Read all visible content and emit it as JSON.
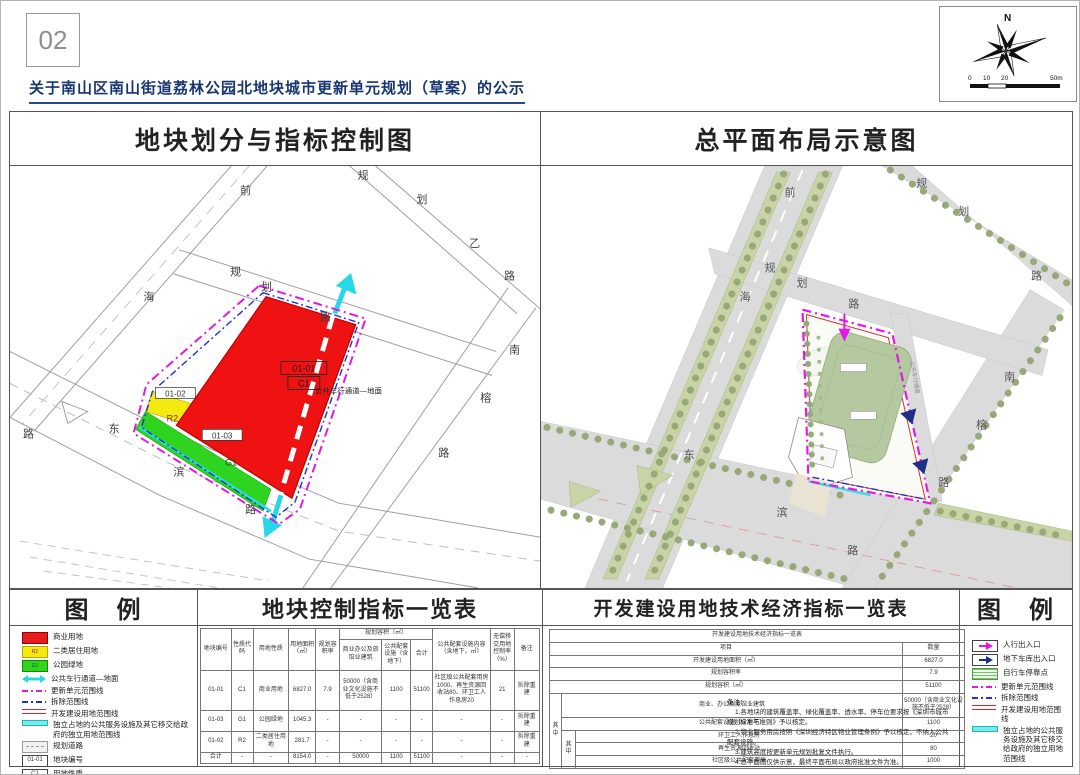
{
  "page": {
    "number": "02",
    "title": "关于南山区南山街道荔林公园北地块城市更新单元规划（草案）的公示"
  },
  "compass": {
    "north_label": "N",
    "scale_labels": [
      "0",
      "10",
      "20",
      "50m"
    ]
  },
  "panels": {
    "left_title": "地块划分与指标控制图",
    "right_title": "总平面布局示意图"
  },
  "left_map": {
    "roads": {
      "qianhai": [
        "前",
        "海",
        "路"
      ],
      "guihua": [
        "规",
        "划",
        "路"
      ],
      "guihuayi": [
        "规",
        "划",
        "乙",
        "路"
      ],
      "nanrong": [
        "南",
        "榕",
        "路"
      ],
      "dongbin": [
        "东",
        "滨",
        "路"
      ]
    },
    "blocks": {
      "b1_code": "01-01",
      "b1_use": "C1",
      "b2_code": "01-02",
      "b2_use": "R2",
      "b3_code": "01-03",
      "b3_use": "G1"
    },
    "annotation": "公共车行通道—地面"
  },
  "right_map": {
    "roads": {
      "qianhai": [
        "前",
        "海"
      ],
      "guihua": [
        "规",
        "划",
        "路"
      ],
      "guihuayi": [
        "规",
        "划",
        "路"
      ],
      "nanrong": [
        "南",
        "榕",
        "路"
      ],
      "dongbin": [
        "东",
        "滨",
        "路"
      ]
    },
    "channel_label": "公共车行通道"
  },
  "legend_left": {
    "title": "图　例",
    "items": [
      {
        "label": "商业用地"
      },
      {
        "label": "二类居住用地",
        "tag": "R2"
      },
      {
        "label": "公园绿地",
        "tag": "G1"
      },
      {
        "label": "公共车行通道—地面"
      },
      {
        "label": "更新单元范围线"
      },
      {
        "label": "拆除范围线"
      },
      {
        "label": "开发建设用地范围线"
      },
      {
        "label": "独立占地的公共服务设施及其它移交给政府的独立用地范围线"
      },
      {
        "label": "规划道路"
      },
      {
        "label": "地块编号",
        "tag": "01-01"
      },
      {
        "label": "用地性质",
        "tag": "C1"
      }
    ]
  },
  "table_mid": {
    "title": "地块控制指标一览表",
    "headers": {
      "code": "地块编号",
      "nature": "性质代码",
      "use": "用地性质",
      "area": "用地面积（㎡）",
      "far": "规划容积率",
      "cap_group": "规划容积（㎡）",
      "cap_biz": "商业办公及旅馆业建筑",
      "cap_pub": "公共配套设施（含地下）",
      "cap_total": "合计",
      "pub_content": "公共配套设施内容（含地下，㎡）",
      "transfer": "无偿移交用地控制率（%）",
      "remark": "备注"
    },
    "rows": [
      {
        "cells": [
          "01-01",
          "C1",
          "商业用地",
          "6827.0",
          "7.9",
          "50000（含商业文化设施不低于2528）",
          "1100",
          "51100",
          "社区级公共配套用房1000、再生资源回收站80、环卫工人作息房20",
          "21",
          "拆除重建"
        ]
      },
      {
        "cells": [
          "01-03",
          "G1",
          "公园绿地",
          "1045.3",
          "-",
          "-",
          "-",
          "-",
          "-",
          "-",
          "拆除重建"
        ]
      },
      {
        "cells": [
          "01-02",
          "R2",
          "二类居住用地",
          "281.7",
          "-",
          "-",
          "-",
          "-",
          "-",
          "-",
          "拆除重建"
        ]
      },
      {
        "cells": [
          "合计",
          "-",
          "-",
          "8154.0",
          "-",
          "50000",
          "1100",
          "51100",
          "-",
          "-",
          "-"
        ]
      }
    ]
  },
  "table_right": {
    "section_title": "开发建设用地技术经济指标一览表",
    "inner_title": "开发建设用地技术经济指标一览表",
    "col_item": "项目",
    "col_qty": "数量",
    "r_area_label": "开发建设用地面积（㎡）",
    "r_area_value": "6827.0",
    "r_far_label": "规划容积率",
    "r_far_value": "7.9",
    "r_cap_label": "规划容积（㎡）",
    "r_cap_value": "51100",
    "among_label": "其中",
    "r_biz_label": "商业、办公及旅馆业建筑",
    "r_biz_value": "50000（含商业文化设施不低于2528）",
    "r_pub_label": "公共配套设施（含地下）",
    "r_pub_value": "1100",
    "among2_label": "其中",
    "r_s1_label": "环卫工人作息房",
    "r_s1_value": "20",
    "r_s2_label": "再生资源回收站",
    "r_s2_value": "80",
    "r_s3_label": "社区级公共配套用房",
    "r_s3_value": "1000",
    "notes_title": "备注：",
    "notes": [
      "1.各地块的建筑覆盖率、绿化覆盖率、透水率、停车位要求按《深圳市城市规划标准与准则》予以核定。",
      "2.物业服务用房按照《深圳经济特区物业管理条例》予以核定，不纳入公共配套设施。",
      "3.建筑高度按更新单元规划批复文件执行。",
      "4.总平面图仅供示意，最终平面布局以政府批准文件为准。"
    ]
  },
  "legend_right": {
    "title": "图　例",
    "items": [
      {
        "label": "人行出入口"
      },
      {
        "label": "地下车库出入口"
      },
      {
        "label": "自行车停靠点"
      },
      {
        "label": "更新单元范围线"
      },
      {
        "label": "拆除范围线"
      },
      {
        "label": "开发建设用地范围线"
      },
      {
        "label": "独立占地的公共服务设施及其它移交给政府的独立用地范围线"
      }
    ]
  }
}
